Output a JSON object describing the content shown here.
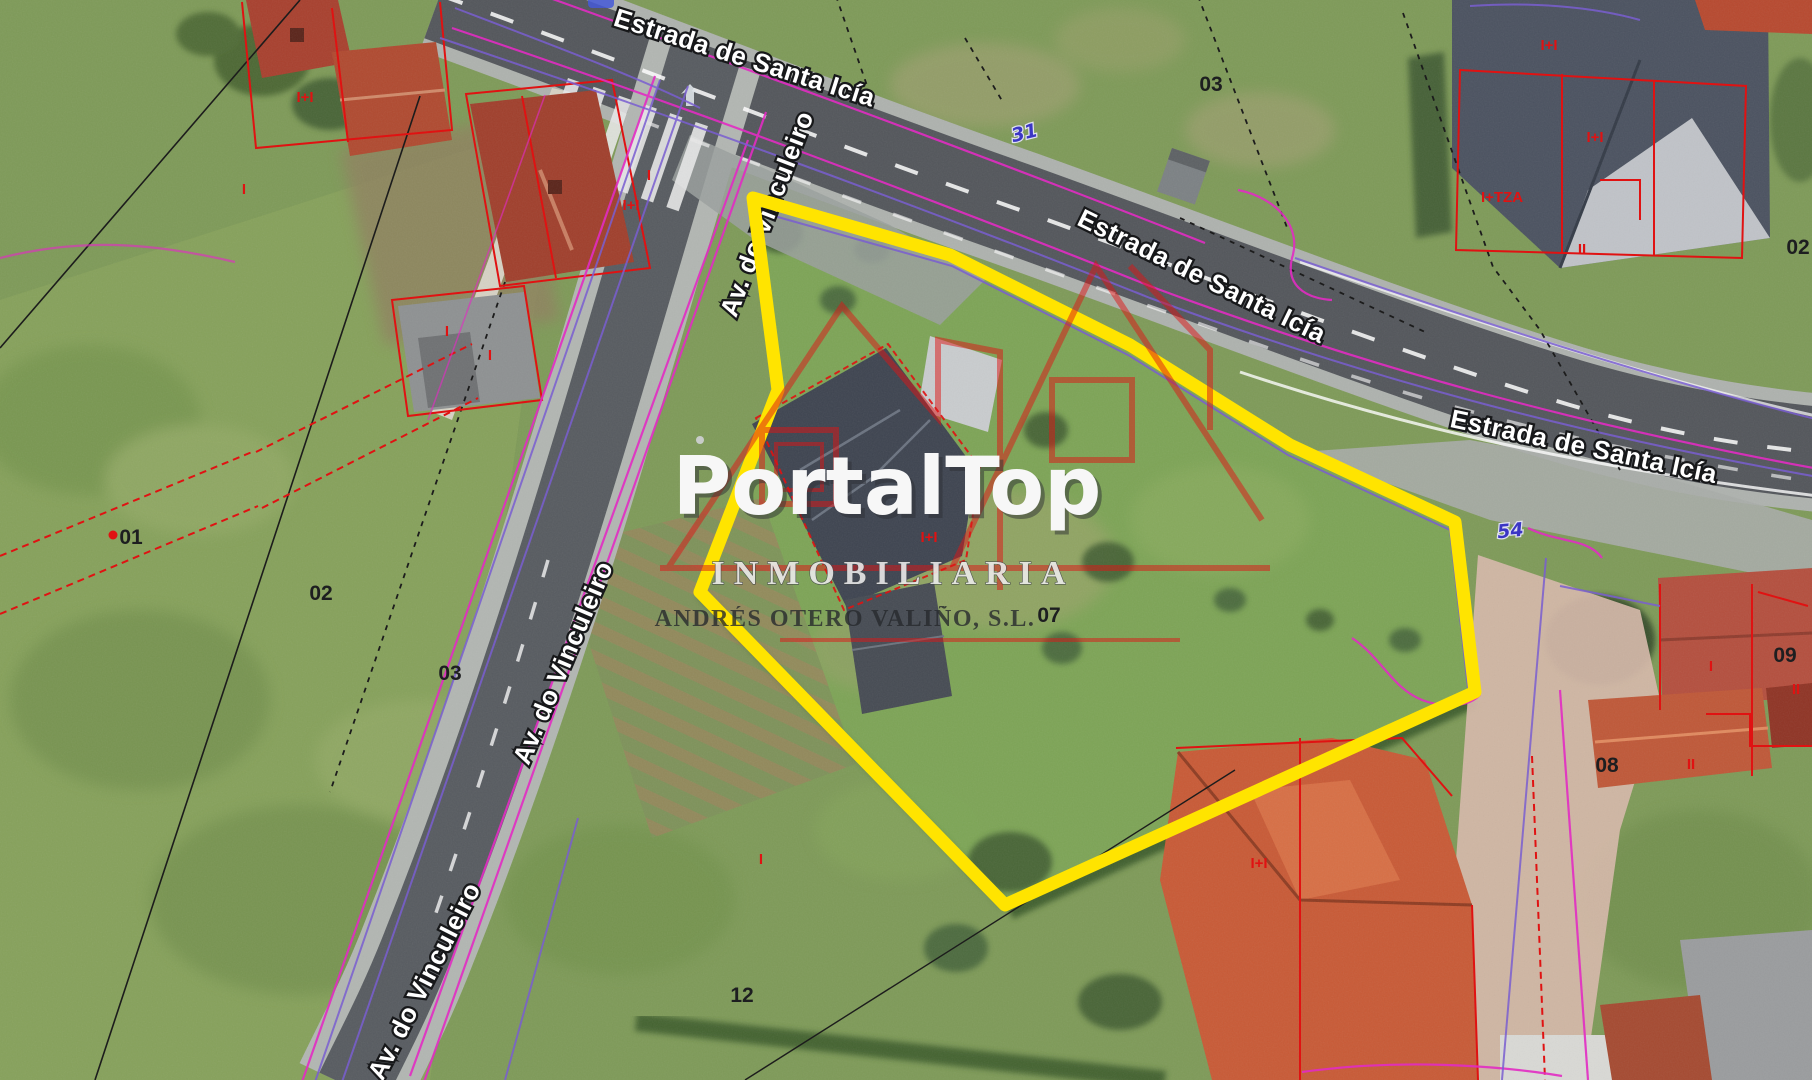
{
  "watermark": {
    "brand": "PortalTop",
    "tagline": "INMOBILIARIA",
    "company": "ANDRÉS OTERO VALIÑO, S.L."
  },
  "roads": {
    "estrada": {
      "label": "Estrada de Santa Icía"
    },
    "vinculeiro": {
      "label": "Av. do Vinculeiro"
    }
  },
  "parcel_numbers": {
    "n01": "01",
    "n02_left": "02",
    "n03_left": "03",
    "n03_top": "03",
    "n07": "07",
    "n08": "08",
    "n09": "09",
    "n12": "12",
    "n02_right": "02"
  },
  "plot_refs": {
    "n31": "31",
    "n54": "54"
  },
  "cadastral_marks": {
    "one": "I",
    "two": "II",
    "one_plus_one": "I+I",
    "one_plus_terrace": "I+TZA"
  },
  "colors": {
    "boundary": "#ffe400",
    "cadastral_red": "#e01212",
    "overlay_magenta": "#e32cc3",
    "overlay_purple": "#7a5fd0",
    "blue_ref": "#3b36c4"
  }
}
